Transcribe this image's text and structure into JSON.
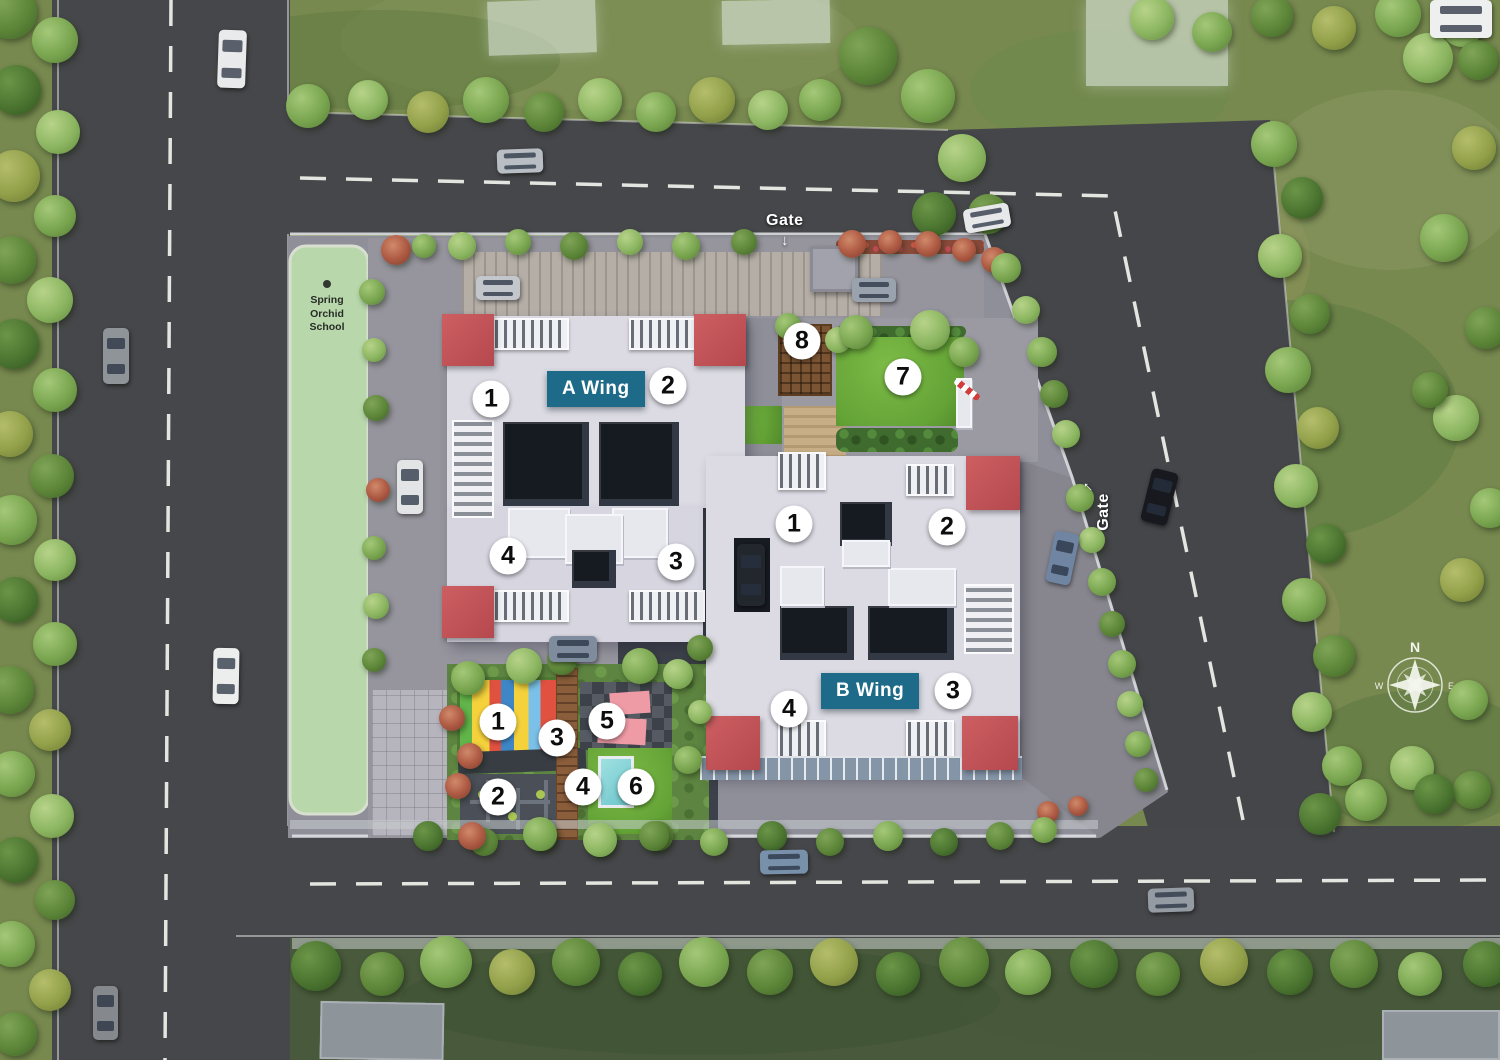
{
  "labels": {
    "wing_a": "A Wing",
    "wing_b": "B Wing",
    "gate_top": "Gate",
    "gate_top_arrow": "↓",
    "gate_right": "Gate",
    "gate_right_arrow": "↑",
    "school": {
      "line1": "Spring",
      "line2": "Orchid",
      "line3": "School"
    },
    "compass": {
      "north": "N",
      "west": "W",
      "east": "E"
    }
  },
  "markers": {
    "wing_a": [
      {
        "n": "1",
        "x": 491,
        "y": 399
      },
      {
        "n": "2",
        "x": 668,
        "y": 386
      },
      {
        "n": "3",
        "x": 676,
        "y": 562
      },
      {
        "n": "4",
        "x": 508,
        "y": 556
      }
    ],
    "wing_b": [
      {
        "n": "1",
        "x": 794,
        "y": 524
      },
      {
        "n": "2",
        "x": 947,
        "y": 527
      },
      {
        "n": "3",
        "x": 953,
        "y": 691
      },
      {
        "n": "4",
        "x": 789,
        "y": 709
      }
    ],
    "amenities": [
      {
        "n": "1",
        "x": 498,
        "y": 722
      },
      {
        "n": "2",
        "x": 498,
        "y": 797
      },
      {
        "n": "3",
        "x": 557,
        "y": 738
      },
      {
        "n": "4",
        "x": 583,
        "y": 787
      },
      {
        "n": "5",
        "x": 607,
        "y": 721
      },
      {
        "n": "6",
        "x": 636,
        "y": 787
      },
      {
        "n": "7",
        "x": 903,
        "y": 377
      },
      {
        "n": "8",
        "x": 802,
        "y": 341
      }
    ]
  },
  "colors": {
    "label_teal": "#1d6b89",
    "canopy_red": "#c05156",
    "road_gray": "#46474a",
    "grass_green": "#77894f",
    "school_green": "#b8d8ab",
    "marker_bg": "#ffffff",
    "marker_text": "#0d0d0d",
    "pool_cyan": "#8bd8da",
    "plaza_pink": "#ef9ba6"
  }
}
